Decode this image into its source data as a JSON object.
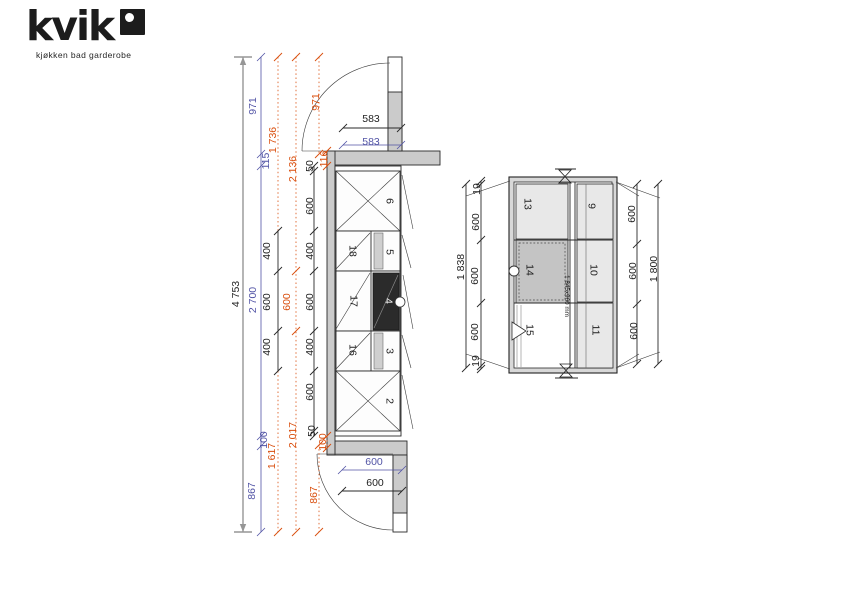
{
  "logo": {
    "brand": "kvik",
    "tagline": "kjøkken bad garderobe"
  },
  "colors": {
    "black": "#1f1f1f",
    "blue": "#5153a5",
    "orange": "#d94e0d",
    "white": "#f0f0f0",
    "wall_gray": "#cbcbcb",
    "module_light": "#e8e8e8",
    "module_mid": "#c4c4c4",
    "module_dark": "#2b2b2b"
  },
  "elevation": {
    "description": "wardrobe run plan with doors",
    "labels": [
      {
        "t": "4 753",
        "x": 236,
        "y": 294,
        "r": "v",
        "c": "black",
        "n": "dim-overall-height"
      },
      {
        "t": "971",
        "x": 253,
        "y": 106,
        "r": "v",
        "c": "blue",
        "n": "dim"
      },
      {
        "t": "115",
        "x": 266,
        "y": 161,
        "r": "v",
        "c": "blue",
        "n": "dim"
      },
      {
        "t": "2 700",
        "x": 253,
        "y": 300,
        "r": "v",
        "c": "blue",
        "n": "dim"
      },
      {
        "t": "100",
        "x": 264,
        "y": 440,
        "r": "v",
        "c": "blue",
        "n": "dim"
      },
      {
        "t": "867",
        "x": 252,
        "y": 491,
        "r": "v",
        "c": "blue",
        "n": "dim"
      },
      {
        "t": "1 736",
        "x": 273,
        "y": 140,
        "r": "v",
        "c": "orange",
        "n": "dim"
      },
      {
        "t": "1 617",
        "x": 272,
        "y": 456,
        "r": "v",
        "c": "orange",
        "n": "dim"
      },
      {
        "t": "400",
        "x": 267,
        "y": 251,
        "r": "v",
        "c": "black",
        "n": "dim"
      },
      {
        "t": "600",
        "x": 267,
        "y": 302,
        "r": "v",
        "c": "black",
        "n": "dim"
      },
      {
        "t": "400",
        "x": 267,
        "y": 347,
        "r": "v",
        "c": "black",
        "n": "dim"
      },
      {
        "t": "2 136",
        "x": 293,
        "y": 169,
        "r": "v",
        "c": "orange",
        "n": "dim"
      },
      {
        "t": "600",
        "x": 287,
        "y": 302,
        "r": "v",
        "c": "orange",
        "n": "dim"
      },
      {
        "t": "2 017",
        "x": 293,
        "y": 435,
        "r": "v",
        "c": "orange",
        "n": "dim"
      },
      {
        "t": "50",
        "x": 310,
        "y": 166,
        "r": "v",
        "c": "black",
        "n": "dim"
      },
      {
        "t": "600",
        "x": 310,
        "y": 206,
        "r": "v",
        "c": "black",
        "n": "dim"
      },
      {
        "t": "400",
        "x": 310,
        "y": 251,
        "r": "v",
        "c": "black",
        "n": "dim"
      },
      {
        "t": "600",
        "x": 310,
        "y": 302,
        "r": "v",
        "c": "black",
        "n": "dim"
      },
      {
        "t": "400",
        "x": 310,
        "y": 347,
        "r": "v",
        "c": "black",
        "n": "dim"
      },
      {
        "t": "600",
        "x": 310,
        "y": 392,
        "r": "v",
        "c": "black",
        "n": "dim"
      },
      {
        "t": "50",
        "x": 312,
        "y": 431,
        "r": "v",
        "c": "black",
        "n": "dim"
      },
      {
        "t": "971",
        "x": 316,
        "y": 102,
        "r": "v",
        "c": "orange",
        "n": "dim"
      },
      {
        "t": "116",
        "x": 324,
        "y": 159,
        "r": "v",
        "c": "orange",
        "n": "dim"
      },
      {
        "t": "100",
        "x": 323,
        "y": 442,
        "r": "v",
        "c": "orange",
        "n": "dim"
      },
      {
        "t": "867",
        "x": 314,
        "y": 495,
        "r": "v",
        "c": "orange",
        "n": "dim"
      },
      {
        "t": "583",
        "x": 371,
        "y": 119,
        "r": "h",
        "c": "black",
        "n": "dim"
      },
      {
        "t": "583",
        "x": 371,
        "y": 142,
        "r": "h",
        "c": "blue",
        "n": "dim"
      },
      {
        "t": "600",
        "x": 374,
        "y": 462,
        "r": "h",
        "c": "blue",
        "n": "dim"
      },
      {
        "t": "600",
        "x": 375,
        "y": 483,
        "r": "h",
        "c": "black",
        "n": "dim"
      },
      {
        "t": "6",
        "x": 389,
        "y": 201,
        "r": "cw",
        "c": "black",
        "n": "cabinet-number-6"
      },
      {
        "t": "18",
        "x": 352,
        "y": 251,
        "r": "cw",
        "c": "black",
        "n": "cabinet-number-18"
      },
      {
        "t": "5",
        "x": 389,
        "y": 252,
        "r": "cw",
        "c": "black",
        "n": "cabinet-number-5"
      },
      {
        "t": "17",
        "x": 353,
        "y": 301,
        "r": "cw",
        "c": "black",
        "n": "cabinet-number-17"
      },
      {
        "t": "4",
        "x": 388,
        "y": 301,
        "r": "cw",
        "c": "white",
        "n": "cabinet-number-4"
      },
      {
        "t": "16",
        "x": 352,
        "y": 350,
        "r": "cw",
        "c": "black",
        "n": "cabinet-number-16"
      },
      {
        "t": "3",
        "x": 389,
        "y": 351,
        "r": "cw",
        "c": "black",
        "n": "cabinet-number-3"
      },
      {
        "t": "2",
        "x": 389,
        "y": 401,
        "r": "cw",
        "c": "black",
        "n": "cabinet-number-2"
      }
    ]
  },
  "plan": {
    "description": "room plan with modules",
    "labels": [
      {
        "t": "1 838",
        "x": 461,
        "y": 267,
        "r": "v",
        "c": "black",
        "n": "dim-room-height-total"
      },
      {
        "t": "19",
        "x": 477,
        "y": 189,
        "r": "v",
        "c": "black",
        "n": "dim"
      },
      {
        "t": "600",
        "x": 476,
        "y": 222,
        "r": "v",
        "c": "black",
        "n": "dim"
      },
      {
        "t": "600",
        "x": 475,
        "y": 276,
        "r": "v",
        "c": "black",
        "n": "dim"
      },
      {
        "t": "600",
        "x": 475,
        "y": 332,
        "r": "v",
        "c": "black",
        "n": "dim"
      },
      {
        "t": "19",
        "x": 476,
        "y": 361,
        "r": "v",
        "c": "black",
        "n": "dim"
      },
      {
        "t": "600",
        "x": 632,
        "y": 214,
        "r": "v",
        "c": "black",
        "n": "dim"
      },
      {
        "t": "600",
        "x": 633,
        "y": 271,
        "r": "v",
        "c": "black",
        "n": "dim"
      },
      {
        "t": "600",
        "x": 634,
        "y": 331,
        "r": "v",
        "c": "black",
        "n": "dim"
      },
      {
        "t": "1 800",
        "x": 654,
        "y": 269,
        "r": "v",
        "c": "black",
        "n": "dim-cabinet-run-total"
      },
      {
        "t": "13",
        "x": 527,
        "y": 204,
        "r": "cw",
        "c": "black",
        "n": "module-number-13"
      },
      {
        "t": "9",
        "x": 591,
        "y": 206,
        "r": "cw",
        "c": "black",
        "n": "module-number-9"
      },
      {
        "t": "14",
        "x": 529,
        "y": 270,
        "r": "cw",
        "c": "black",
        "n": "module-number-14"
      },
      {
        "t": "10",
        "x": 593,
        "y": 270,
        "r": "cw",
        "c": "black",
        "n": "module-number-10"
      },
      {
        "t": "15",
        "x": 529,
        "y": 330,
        "r": "cw",
        "c": "black",
        "n": "module-number-15"
      },
      {
        "t": "11",
        "x": 595,
        "y": 330,
        "r": "cw",
        "c": "black",
        "n": "module-number-11"
      },
      {
        "t": "1 845x960 mm",
        "x": 566,
        "y": 296,
        "r": "cw",
        "c": "black",
        "s": "small",
        "n": "floor-area-size-label"
      }
    ]
  }
}
